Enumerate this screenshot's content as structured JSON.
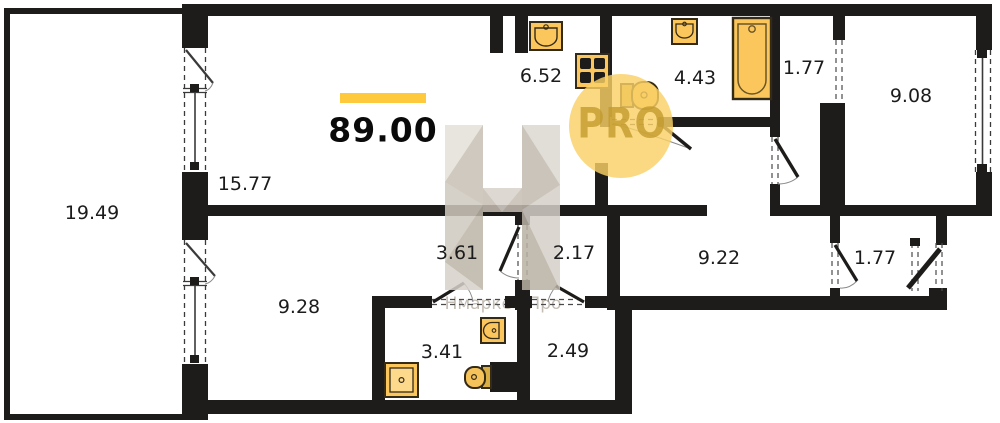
{
  "plan": {
    "total_area": "89.00",
    "logo_text": "PRO",
    "watermark_text": "Нмаркет.Про",
    "rooms": [
      {
        "name": "balcony",
        "area": "19.49"
      },
      {
        "name": "living-room",
        "area": "15.77"
      },
      {
        "name": "kitchen",
        "area": "6.52"
      },
      {
        "name": "bathroom-top",
        "area": "4.43"
      },
      {
        "name": "hall-top",
        "area": "1.77"
      },
      {
        "name": "bedroom-right",
        "area": "9.08"
      },
      {
        "name": "hallway",
        "area": "9.22"
      },
      {
        "name": "entry-hall",
        "area": "1.77"
      },
      {
        "name": "corridor-left",
        "area": "3.61"
      },
      {
        "name": "corridor-right",
        "area": "2.17"
      },
      {
        "name": "bedroom-left",
        "area": "9.28"
      },
      {
        "name": "bathroom-bottom",
        "area": "3.41"
      },
      {
        "name": "storage",
        "area": "2.49"
      }
    ],
    "fixtures": [
      "kitchen-sink",
      "stove",
      "toilet",
      "sink",
      "bathtub",
      "shower",
      "sink",
      "toilet"
    ],
    "colors": {
      "wall": "#1E1C1A",
      "fixture_fill": "#FBC75D",
      "fixture_stroke": "#342A18",
      "accent_bar": "#FFC93E",
      "pro_circle": "#F9D167",
      "pro_text": "#C2992C",
      "watermark_grey": "#CCC5BB"
    }
  }
}
